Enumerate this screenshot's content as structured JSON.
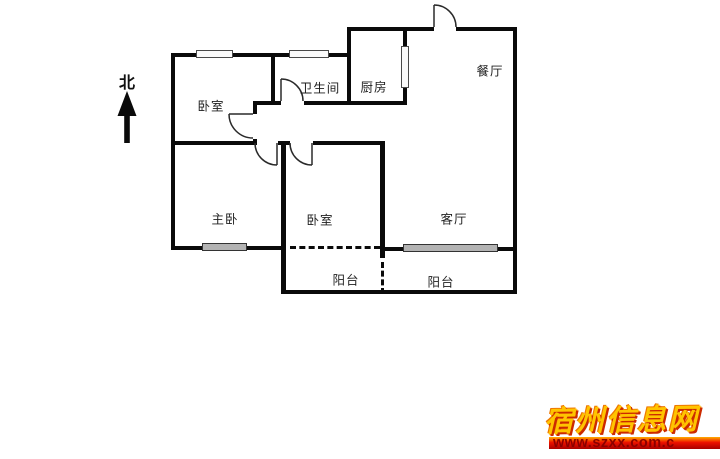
{
  "compass": {
    "label": "北"
  },
  "rooms": [
    {
      "id": "bedroom-north",
      "label": "卧室"
    },
    {
      "id": "bathroom",
      "label": "卫生间"
    },
    {
      "id": "kitchen",
      "label": "厨房"
    },
    {
      "id": "dining-room",
      "label": "餐厅"
    },
    {
      "id": "master-bedroom",
      "label": "主卧"
    },
    {
      "id": "bedroom-south",
      "label": "卧室"
    },
    {
      "id": "living-room",
      "label": "客厅"
    },
    {
      "id": "balcony-west",
      "label": "阳台"
    },
    {
      "id": "balcony-east",
      "label": "阳台"
    }
  ],
  "watermark": {
    "site_name": "宿州信息网",
    "url": "www.szxx.com.c",
    "colors": {
      "gold": "#ffc400",
      "shadow_red": "#cc2a00",
      "bar_top": "#ffae00",
      "bar_bottom": "#a80000"
    }
  }
}
